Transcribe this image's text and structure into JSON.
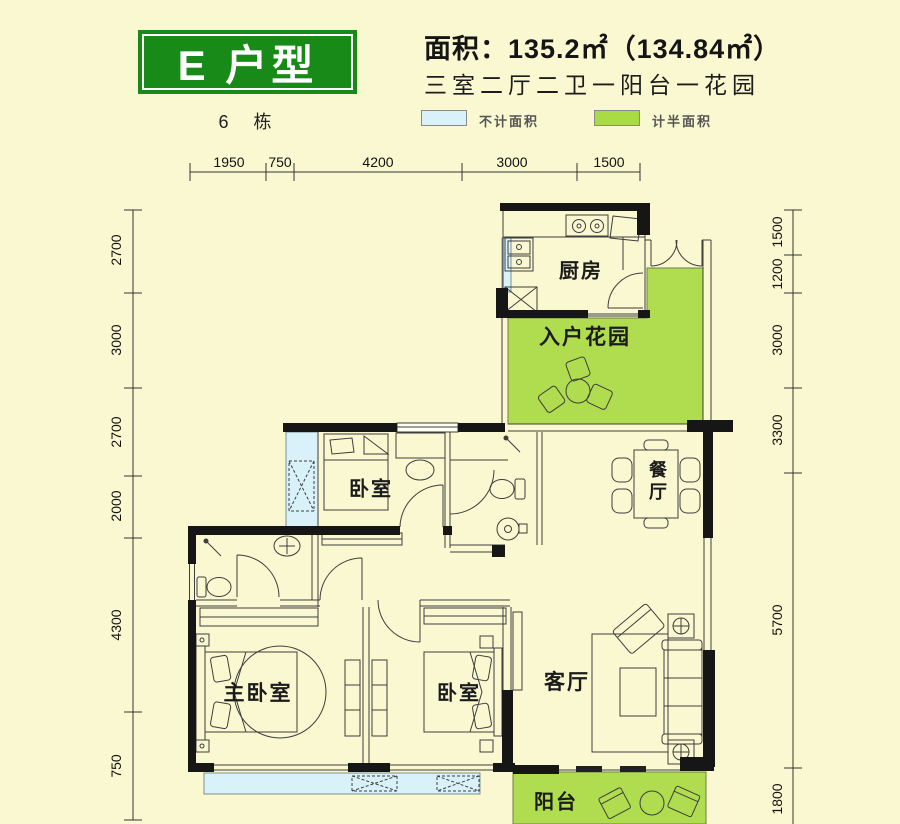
{
  "header": {
    "unit_title": "E 户型",
    "building": "6 栋",
    "area_line": "面积：135.2㎡（134.84㎡）",
    "layout_line": "三室二厅二卫一阳台一花园",
    "legend": [
      {
        "label": "不计面积",
        "color": "#d9f1f8"
      },
      {
        "label": "计半面积",
        "color": "#a9dc44"
      }
    ]
  },
  "dimensions": {
    "top": [
      "1950",
      "750",
      "4200",
      "3000",
      "1500"
    ],
    "left": [
      "2700",
      "3000",
      "2700",
      "2000",
      "4300",
      "750"
    ],
    "right": [
      "1500",
      "1200",
      "3000",
      "3300",
      "5700",
      "1800"
    ]
  },
  "rooms": {
    "kitchen": "厨房",
    "entry_garden": "入户花园",
    "bedroom_top": "卧室",
    "dining": "餐厅",
    "master_bedroom": "主卧室",
    "bedroom_second": "卧室",
    "living": "客厅",
    "balcony": "阳台"
  },
  "colors": {
    "background": "#f9f8d0",
    "title_green": "#188a18",
    "half_area_green": "#b0dc4f",
    "no_area_blue": "#d9f1f8",
    "wall_black": "#161616"
  }
}
